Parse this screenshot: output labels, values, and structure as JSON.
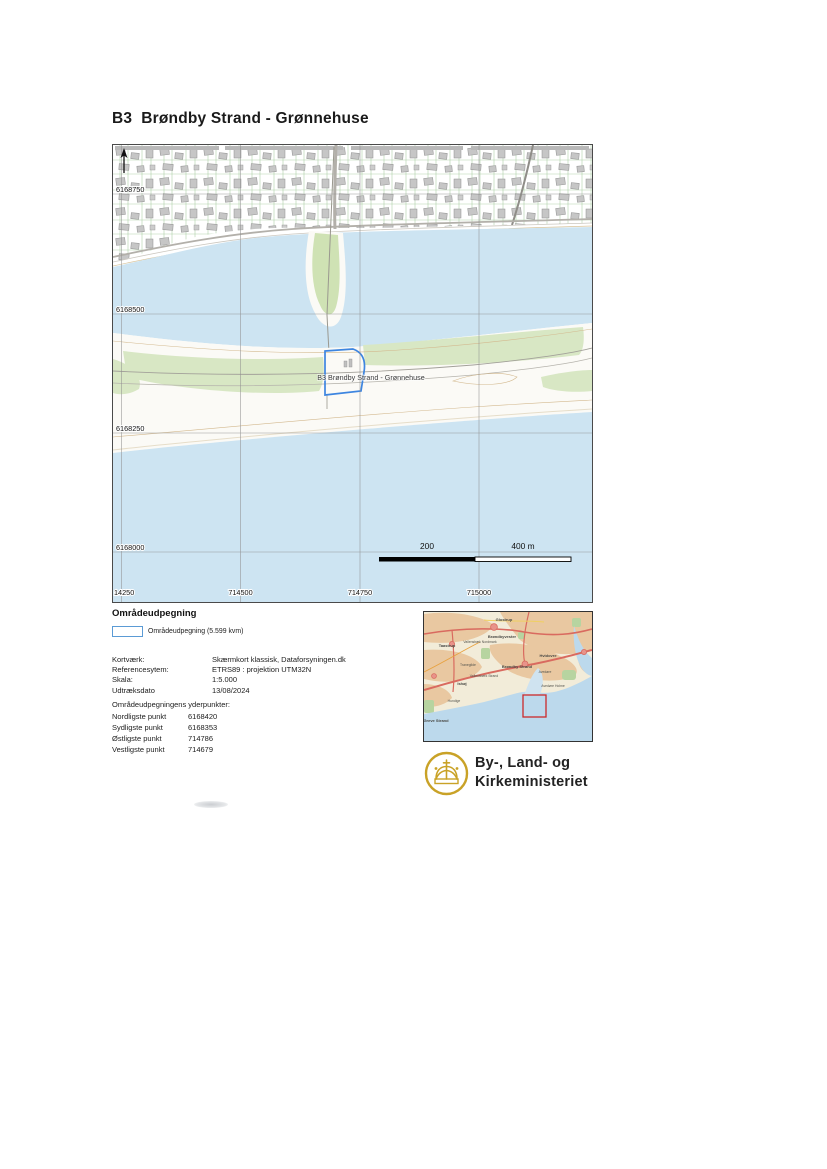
{
  "page": {
    "title": "B3  Brøndby Strand - Grønnehuse"
  },
  "main_map": {
    "area_label": "B3 Brøndby Strand - Grønnehuse",
    "y_labels": [
      "6168750",
      "6168500",
      "6168250",
      "6168000"
    ],
    "x_labels": [
      "14250",
      "714500",
      "714750",
      "715000"
    ],
    "scale_labels": {
      "mid": "200",
      "end": "400 m"
    },
    "colors": {
      "water": "#cde4f2",
      "vegetation": "#d8e7c4",
      "building": "#c6c6c6",
      "selection_outline": "#3d85e0"
    }
  },
  "legend": {
    "heading": "Områdeudpegning",
    "items": [
      {
        "label": "Områdeudpegning (5.599 kvm)",
        "swatch_border": "#5b9bd5"
      }
    ]
  },
  "map_info": {
    "rows": [
      {
        "label": "Kortværk:",
        "value": "Skærmkort klassisk, Dataforsyningen.dk"
      },
      {
        "label": "Referencesytem:",
        "value": "ETRS89 : projektion UTM32N"
      },
      {
        "label": "Skala:",
        "value": "1:5.000"
      },
      {
        "label": "Udtræksdato",
        "value": "13/08/2024"
      }
    ]
  },
  "extent": {
    "heading": "Områdeudpegningens yderpunkter:",
    "rows": [
      {
        "label": "Nordligste punkt",
        "value": "6168420"
      },
      {
        "label": "Sydligste punkt",
        "value": "6168353"
      },
      {
        "label": "Østligste punkt",
        "value": "714786"
      },
      {
        "label": "Vestligste punkt",
        "value": "714679"
      }
    ]
  },
  "overview_map": {
    "marker_color": "#cc2a2a",
    "labels": [
      "Glostrup",
      "Brøndbyvester",
      "Taastrup",
      "Vallensbæk Nordmark",
      "Hvidovre",
      "Brøndby Strand",
      "Avedøre",
      "Tranegilde",
      "Vallensbæk Strand",
      "Avedøre Holme",
      "Ishøj",
      "Hundige",
      "Greve Strand"
    ]
  },
  "ministry": {
    "name_line1": "By-, Land- og",
    "name_line2": "Kirkeministeriet",
    "logo_color": "#c9a227"
  }
}
